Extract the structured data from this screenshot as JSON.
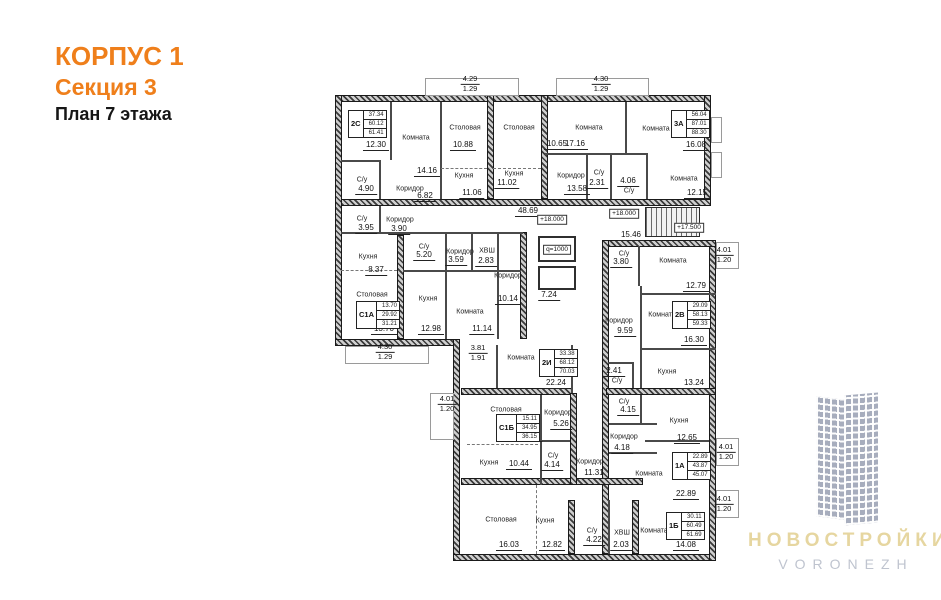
{
  "header": {
    "building": "КОРПУС 1",
    "section": "Секция 3",
    "floor": "План 7 этажа"
  },
  "colors": {
    "accent": "#ef7f1b",
    "wall": "#3a3a3a",
    "logo_building": "#a7adbd",
    "logo_name": "#e6d6a0",
    "logo_city": "#bfc4cf"
  },
  "plan": {
    "rooms": [
      {
        "name": "Комната",
        "area": "12.30",
        "nx": 366,
        "ny": 133,
        "ax": 376,
        "ay": 146
      },
      {
        "name": "Комната",
        "area": "14.16",
        "nx": 416,
        "ny": 138,
        "ax": 427,
        "ay": 172
      },
      {
        "name": "Столовая",
        "area": "10.88",
        "nx": 465,
        "ny": 128,
        "ax": 463,
        "ay": 146
      },
      {
        "name": "Кухня",
        "area": "11.06",
        "nx": 464,
        "ny": 176,
        "ax": 472,
        "ay": 194
      },
      {
        "name": "Столовая",
        "area": "10.65",
        "nx": 519,
        "ny": 128,
        "ax": 557,
        "ay": 145
      },
      {
        "name": "Кухня",
        "area": "11.02",
        "nx": 514,
        "ny": 174,
        "ax": 507,
        "ay": 184
      },
      {
        "name": "С/у",
        "area": "4.90",
        "nx": 362,
        "ny": 180,
        "ax": 366,
        "ay": 190
      },
      {
        "name": "Коридор",
        "area": "6.82",
        "nx": 410,
        "ny": 189,
        "ax": 425,
        "ay": 197
      },
      {
        "name": "Комната",
        "area": "17.16",
        "nx": 589,
        "ny": 128,
        "ax": 575,
        "ay": 145
      },
      {
        "name": "Комната",
        "area": "16.08",
        "nx": 656,
        "ny": 129,
        "ax": 696,
        "ay": 146
      },
      {
        "name": "Коридор",
        "area": "13.58",
        "nx": 571,
        "ny": 176,
        "ax": 577,
        "ay": 190
      },
      {
        "name": "С/у",
        "area": "2.31",
        "nx": 599,
        "ny": 173,
        "ax": 597,
        "ay": 184
      },
      {
        "name": "С/у",
        "area": "4.06",
        "nx": 629,
        "ny": 191,
        "ax": 628,
        "ay": 182
      },
      {
        "name": "Комната",
        "area": "12.15",
        "nx": 684,
        "ny": 179,
        "ax": 697,
        "ay": 194
      },
      {
        "name": "С/у",
        "area": "3.95",
        "nx": 362,
        "ny": 219,
        "ax": 366,
        "ay": 229
      },
      {
        "name": "Коридор",
        "area": "3.90",
        "nx": 400,
        "ny": 220,
        "ax": 399,
        "ay": 230
      },
      {
        "name": "Кухня",
        "area": "8.37",
        "nx": 368,
        "ny": 257,
        "ax": 376,
        "ay": 271
      },
      {
        "name": "С/у",
        "area": "5.20",
        "nx": 424,
        "ny": 247,
        "ax": 424,
        "ay": 256
      },
      {
        "name": "Коридор",
        "area": "3.59",
        "nx": 460,
        "ny": 252,
        "ax": 456,
        "ay": 261
      },
      {
        "name": "ХВШ",
        "area": "2.83",
        "nx": 487,
        "ny": 251,
        "ax": 486,
        "ay": 262
      },
      {
        "name": "Коридор",
        "area": "",
        "nx": 508,
        "ny": 276,
        "ax": 0,
        "ay": 0
      },
      {
        "name": "Столовая",
        "area": "13.70",
        "nx": 372,
        "ny": 295,
        "ax": 384,
        "ay": 330
      },
      {
        "name": "Кухня",
        "area": "12.98",
        "nx": 428,
        "ny": 299,
        "ax": 431,
        "ay": 330
      },
      {
        "name": "Комната",
        "area": "11.14",
        "nx": 470,
        "ny": 312,
        "ax": 482,
        "ay": 330
      },
      {
        "name": "",
        "area": "48.69",
        "ax": 528,
        "ay": 212
      },
      {
        "name": "",
        "area": "10.14",
        "ax": 508,
        "ay": 300
      },
      {
        "name": "",
        "area": "7.24",
        "ax": 549,
        "ay": 296
      },
      {
        "name": "",
        "area": "15.46",
        "ax": 631,
        "ay": 236
      },
      {
        "name": "С/у",
        "area": "3.80",
        "nx": 624,
        "ny": 254,
        "ax": 621,
        "ay": 263
      },
      {
        "name": "Комната",
        "area": "12.79",
        "nx": 673,
        "ny": 261,
        "ax": 696,
        "ay": 287
      },
      {
        "name": "Коридор",
        "area": "9.59",
        "nx": 619,
        "ny": 321,
        "ax": 625,
        "ay": 332
      },
      {
        "name": "Комната",
        "area": "16.30",
        "nx": 662,
        "ny": 315,
        "ax": 694,
        "ay": 341
      },
      {
        "name": "Комната",
        "area": "22.24",
        "nx": 521,
        "ny": 358,
        "ax": 556,
        "ay": 384
      },
      {
        "name": "Столовая",
        "area": "15.11",
        "nx": 506,
        "ny": 410,
        "ax": 530,
        "ay": 437
      },
      {
        "name": "Коридор",
        "area": "5.26",
        "nx": 558,
        "ny": 413,
        "ax": 561,
        "ay": 425
      },
      {
        "name": "Кухня",
        "area": "10.44",
        "nx": 489,
        "ny": 463,
        "ax": 519,
        "ay": 465
      },
      {
        "name": "С/у",
        "area": "4.14",
        "nx": 553,
        "ny": 456,
        "ax": 552,
        "ay": 466
      },
      {
        "name": "Коридор",
        "area": "11.31",
        "nx": 590,
        "ny": 462,
        "ax": 594,
        "ay": 474
      },
      {
        "name": "С/у",
        "area": "2.41",
        "nx": 617,
        "ny": 381,
        "ax": 614,
        "ay": 372
      },
      {
        "name": "С/у",
        "area": "4.15",
        "nx": 624,
        "ny": 402,
        "ax": 628,
        "ay": 411
      },
      {
        "name": "Коридор",
        "area": "4.18",
        "nx": 624,
        "ny": 437,
        "ax": 622,
        "ay": 449
      },
      {
        "name": "Кухня",
        "area": "13.24",
        "nx": 667,
        "ny": 372,
        "ax": 694,
        "ay": 384
      },
      {
        "name": "Кухня",
        "area": "12.65",
        "nx": 679,
        "ny": 421,
        "ax": 687,
        "ay": 439
      },
      {
        "name": "Комната",
        "area": "22.89",
        "nx": 649,
        "ny": 474,
        "ax": 686,
        "ay": 495
      },
      {
        "name": "Столовая",
        "area": "16.03",
        "nx": 501,
        "ny": 520,
        "ax": 509,
        "ay": 546
      },
      {
        "name": "Кухня",
        "area": "12.82",
        "nx": 545,
        "ny": 521,
        "ax": 552,
        "ay": 546
      },
      {
        "name": "С/у",
        "area": "4.22",
        "nx": 592,
        "ny": 531,
        "ax": 594,
        "ay": 541
      },
      {
        "name": "ХВШ",
        "area": "2.03",
        "nx": 622,
        "ny": 533,
        "ax": 621,
        "ay": 546
      },
      {
        "name": "Комната",
        "area": "14.08",
        "nx": 654,
        "ny": 531,
        "ax": 686,
        "ay": 546
      }
    ],
    "apartments": [
      {
        "type": "2С",
        "values": [
          "37.34",
          "60.12",
          "61.41"
        ],
        "x": 348,
        "y": 110
      },
      {
        "type": "3А",
        "values": [
          "56.04",
          "87.01",
          "88.30"
        ],
        "x": 671,
        "y": 110
      },
      {
        "type": "С1А",
        "values": [
          "13.70",
          "29.92",
          "31.21"
        ],
        "x": 356,
        "y": 301
      },
      {
        "type": "2В",
        "values": [
          "29.09",
          "58.13",
          "59.33"
        ],
        "x": 672,
        "y": 301
      },
      {
        "type": "2И",
        "values": [
          "33.38",
          "68.12",
          "70.03"
        ],
        "x": 539,
        "y": 349
      },
      {
        "type": "С1Б",
        "values": [
          "15.11",
          "34.95",
          "36.15"
        ],
        "x": 496,
        "y": 414
      },
      {
        "type": "1А",
        "values": [
          "22.89",
          "43.87",
          "45.07"
        ],
        "x": 672,
        "y": 452
      },
      {
        "type": "1Б",
        "values": [
          "30.11",
          "60.49",
          "61.69"
        ],
        "x": 666,
        "y": 512
      }
    ],
    "dims": [
      {
        "top": "4.29",
        "bottom": "1.29",
        "x": 470,
        "y": 84
      },
      {
        "top": "4.30",
        "bottom": "1.29",
        "x": 601,
        "y": 84
      },
      {
        "top": "4.30",
        "bottom": "1.29",
        "x": 385,
        "y": 352
      },
      {
        "top": "3.81",
        "bottom": "1.91",
        "x": 478,
        "y": 353
      },
      {
        "top": "4.01",
        "bottom": "1.20",
        "x": 724,
        "y": 255
      },
      {
        "top": "4.01",
        "bottom": "1.20",
        "x": 447,
        "y": 404
      },
      {
        "top": "4.01",
        "bottom": "1.20",
        "x": 726,
        "y": 452
      },
      {
        "top": "4.01",
        "bottom": "1.20",
        "x": 724,
        "y": 504
      }
    ],
    "marks": [
      {
        "text": "+18.000",
        "x": 552,
        "y": 220
      },
      {
        "text": "+18.000",
        "x": 624,
        "y": 214
      },
      {
        "text": "+17.500",
        "x": 689,
        "y": 228
      },
      {
        "text": "q=1000",
        "x": 557,
        "y": 250
      }
    ]
  },
  "logo": {
    "name": "НОВОСТРОЙКИ",
    "city": "VORONEZH"
  }
}
